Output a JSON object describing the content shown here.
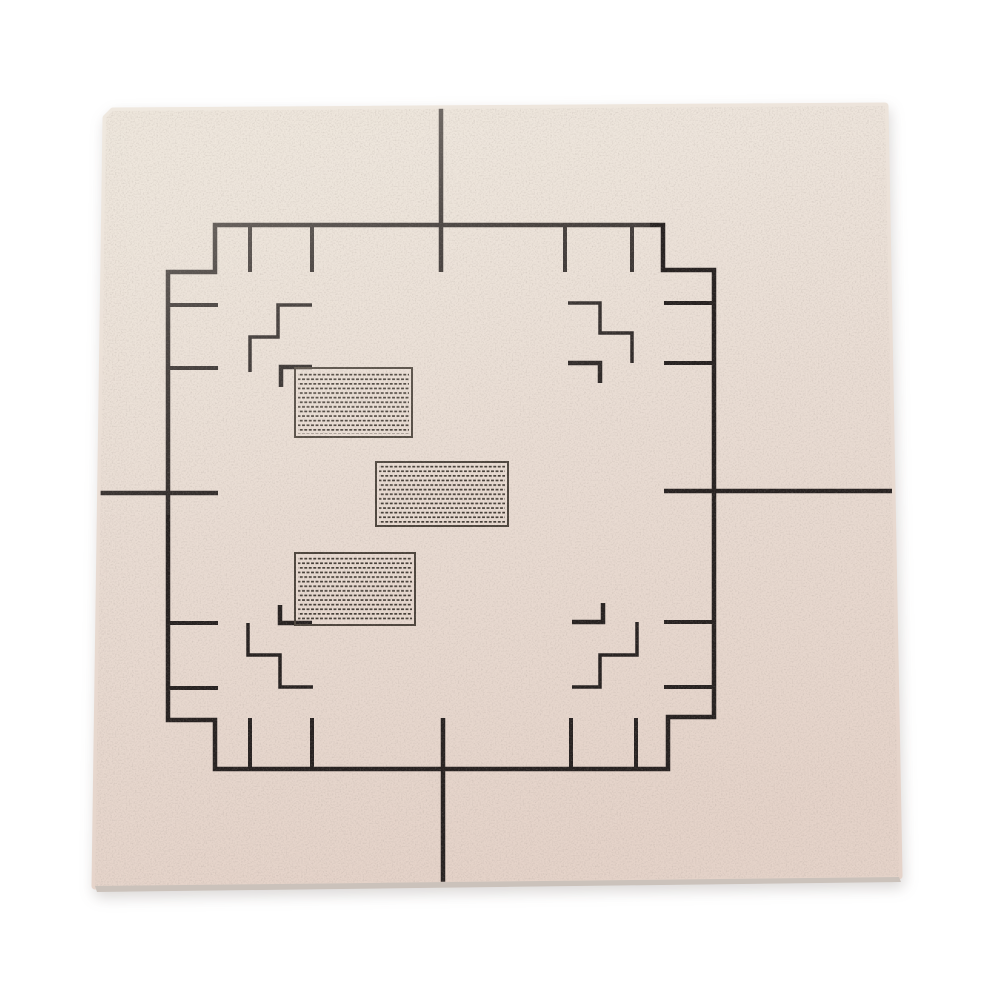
{
  "scene": {
    "type": "product-photo",
    "description": "Top-down photograph of a square light-beige ceramic substrate plate on a white background, screen-printed with dark alignment markings: a stepped square fiducial border with inward tick marks, four staircase registration marks and four corner brackets inside the border, crosshair lines entering from the middle of each plate edge, and three rectangular pads filled with a fine dashed brick-hatch pattern"
  },
  "markings": {
    "fiducial_border": "stepped square with notched corners",
    "hatched_pads": 3,
    "staircase_marks": 4,
    "corner_brackets": 4,
    "edge_tick_marks": 16,
    "crosshair_lines": 4
  },
  "colors": {
    "page_bg": "#ffffff",
    "plate_top": "#efe8df",
    "plate_mid": "#e9dcd3",
    "plate_bottom": "#e5d3c9",
    "plate_edge": "#cbc2bb",
    "ink": "#262120",
    "ink_soft": "#4d453d",
    "hatch_dash": "#453e37",
    "fade_tint": "#ede5da"
  }
}
